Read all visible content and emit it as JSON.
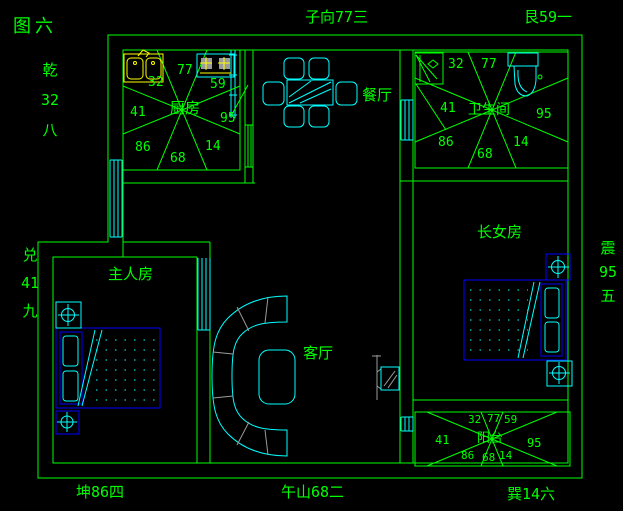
{
  "figure_label": "图六",
  "compass": {
    "qian": {
      "chars": [
        "乾",
        "32",
        "八"
      ]
    },
    "dui": {
      "chars": [
        "兑",
        "41",
        "九"
      ]
    },
    "zhen": {
      "chars": [
        "震",
        "95",
        "五"
      ]
    },
    "zi": "子向77三",
    "gen": "艮59一",
    "kun": "坤86四",
    "wu": "午山68二",
    "xun": "巽14六"
  },
  "rooms": {
    "kitchen": {
      "label": "厨房",
      "stars": {
        "nw": "32",
        "n": "77",
        "ne": "59",
        "w": "41",
        "e": "95",
        "sw": "86",
        "s": "68",
        "se": "14"
      }
    },
    "bathroom": {
      "label": "卫生间",
      "stars": {
        "nw": "32",
        "n": "77",
        "w": "41",
        "e": "95",
        "sw": "86",
        "s": "68",
        "se": "14"
      }
    },
    "balcony": {
      "label": "阳台",
      "stars": {
        "nw": "32",
        "n": "77",
        "ne": "59",
        "w": "41",
        "e": "95",
        "sw": "86",
        "s": "68",
        "se": "14"
      }
    },
    "dining": {
      "label": "餐厅"
    },
    "living": {
      "label": "客厅"
    },
    "master": {
      "label": "主人房"
    },
    "daughter": {
      "label": "长女房"
    }
  },
  "colors": {
    "line": "#00ff00",
    "furniture": "#00ffff",
    "bed": "#0000ff",
    "fixture": "#ffff00",
    "detail": "#9b9b9b",
    "background": "#000000"
  }
}
